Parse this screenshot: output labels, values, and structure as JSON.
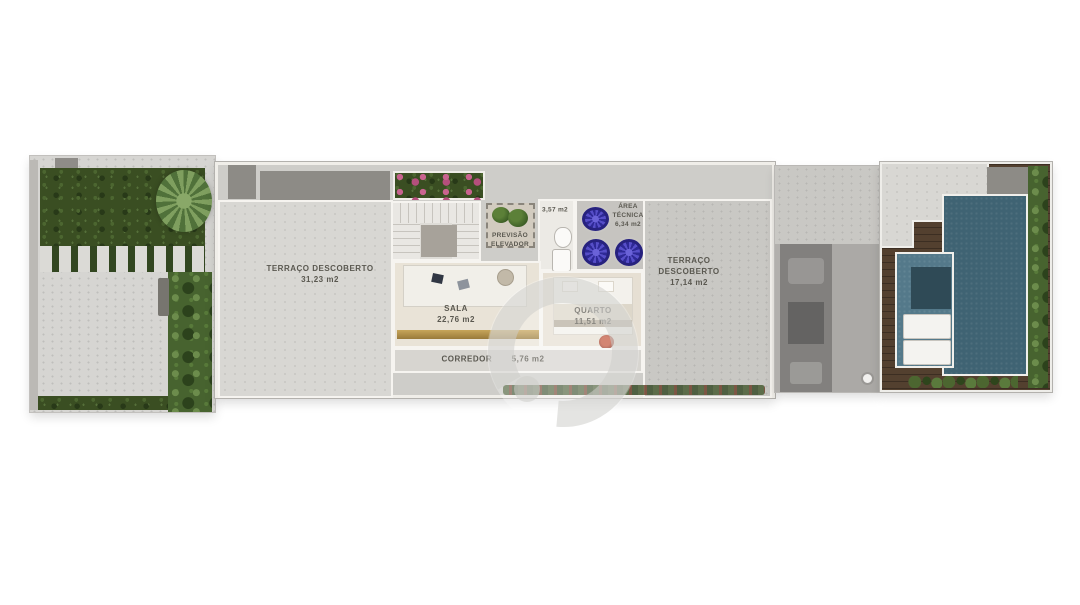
{
  "plan": {
    "rooms": {
      "terraco_left": {
        "label": "TERRAÇO DESCOBERTO",
        "area": "31,23 m2"
      },
      "sala": {
        "label": "SALA",
        "area": "22,76 m2"
      },
      "quarto": {
        "label": "QUARTO",
        "area": "11,51 m2"
      },
      "corredor": {
        "label": "CORREDOR",
        "area": "5,76 m2"
      },
      "banho": {
        "area": "3,57 m2"
      },
      "area_tecnica": {
        "label_line1": "ÁREA",
        "label_line2": "TÉCNICA",
        "area": "6,34 m2"
      },
      "previsao_elevador": {
        "label_line1": "PREVISÃO",
        "label_line2": "ELEVADOR"
      },
      "terraco_right": {
        "label_line1": "TERRAÇO",
        "label_line2": "DESCOBERTO",
        "area": "17,14 m2"
      }
    },
    "colors": {
      "pool_water": "#3f6373",
      "pool_shallow": "#54798a",
      "deck_wood": "#53402f",
      "hedge_green": "#3a4e22",
      "ac_unit_blue": "#4740b8",
      "flower_pink": "#c9638f",
      "window_sill_gold": "#b49246",
      "concrete": "#d6d5d2",
      "label_text": "#5a5850"
    },
    "watermark_icon": "e-logo-watermark"
  }
}
